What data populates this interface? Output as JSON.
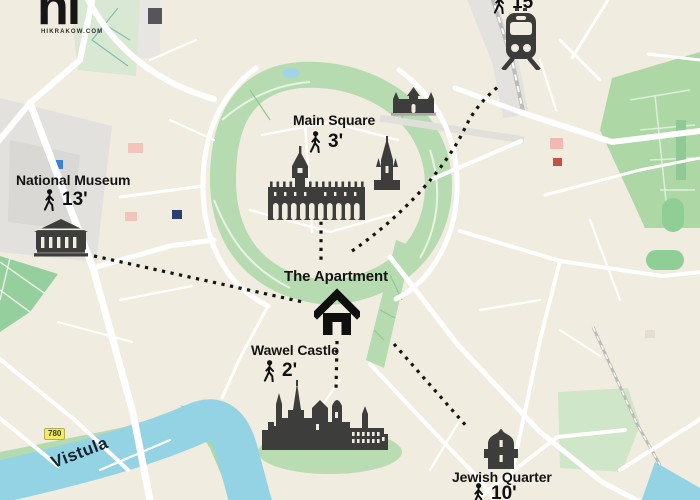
{
  "brand": {
    "logo_text": "hi",
    "site": "HIKRAKOW.COM"
  },
  "apartment": {
    "label": "The Apartment"
  },
  "pois": {
    "main_square": {
      "label": "Main Square",
      "time": "3'"
    },
    "national_museum": {
      "label": "National Museum",
      "time": "13'"
    },
    "wawel_castle": {
      "label": "Wawel Castle",
      "time": "2'"
    },
    "jewish_quarter": {
      "label": "Jewish Quarter",
      "time": "10'"
    },
    "train_station": {
      "time": "15'"
    }
  },
  "map": {
    "river_label": "Vistula",
    "route_badge": "780",
    "colors": {
      "land": "#f0ecdf",
      "old_town": "#f3efe2",
      "park": "#b7dbb0",
      "water": "#94d3e4",
      "road": "#ffffff",
      "building_silhouette": "#3d3d3b",
      "route_dots": "#141414",
      "badge_yellow": "#f3ec62"
    }
  },
  "icons": {
    "apartment": "house-icon",
    "walk": "walking-person-icon",
    "main_square": "cloth-hall-icon",
    "main_square_extra_1": "st-marys-tower-icon",
    "main_square_extra_2": "city-gate-icon",
    "national_museum": "museum-icon",
    "wawel_castle": "castle-icon",
    "jewish_quarter": "synagogue-icon",
    "train_station": "train-icon"
  }
}
